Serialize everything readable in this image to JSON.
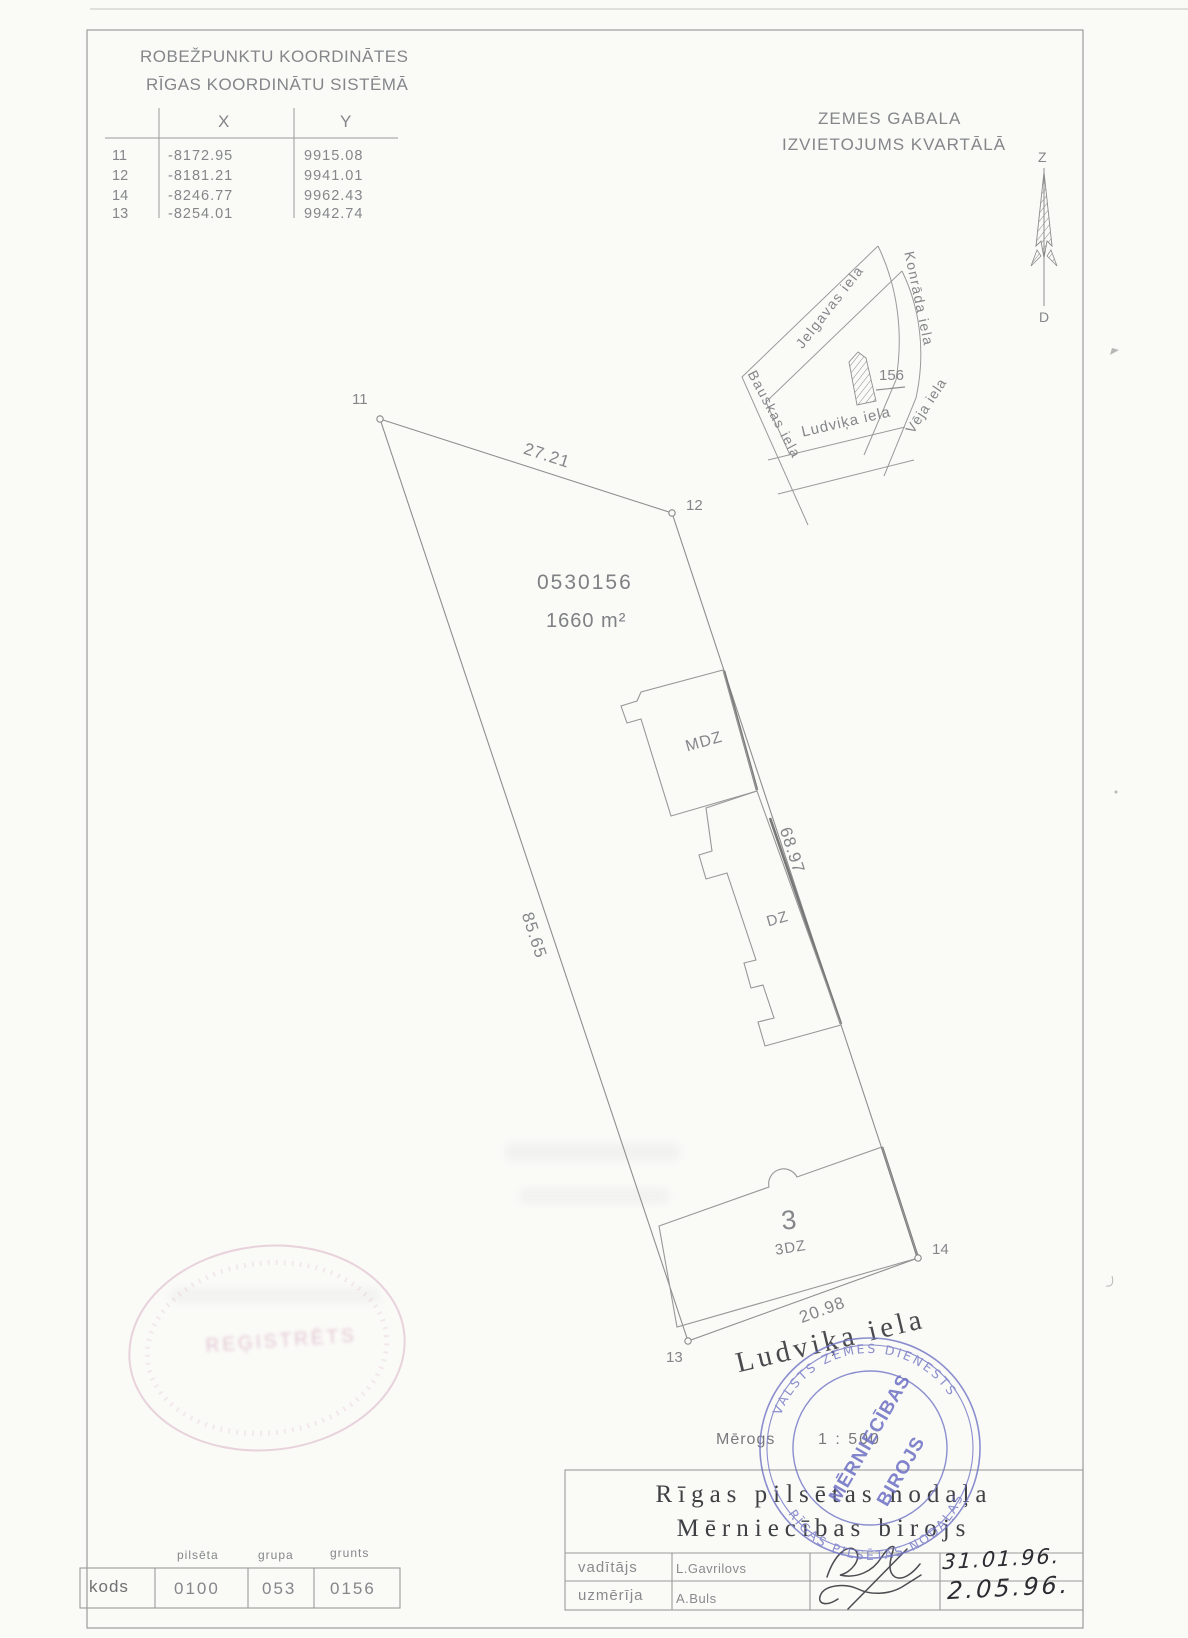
{
  "coordinate_table": {
    "title_line1": "ROBEŽPUNKTU KOORDINĀTES",
    "title_line2": "RĪGAS KOORDINĀTU SISTĒMĀ",
    "col_x": "X",
    "col_y": "Y",
    "rows": [
      {
        "point": "11",
        "x": "-8172.95",
        "y": "9915.08"
      },
      {
        "point": "12",
        "x": "-8181.21",
        "y": "9941.01"
      },
      {
        "point": "14",
        "x": "-8246.77",
        "y": "9962.43"
      },
      {
        "point": "13",
        "x": "-8254.01",
        "y": "9942.74"
      }
    ]
  },
  "location_map": {
    "title_line1": "ZEMES GABALA",
    "title_line2": "IZVIETOJUMS KVARTĀLĀ",
    "north_label": "Z",
    "south_label": "D",
    "streets": {
      "jelgavas": "Jelgavas iela",
      "konrada": "Konrāda iela",
      "bauskas": "Bauskas iela",
      "ludvika": "Ludviķa iela",
      "veja": "Vēja iela"
    },
    "parcel_label": "156"
  },
  "plan": {
    "parcel_number": "0530156",
    "area_label": "1660 m²",
    "point_labels": {
      "p11": "11",
      "p12": "12",
      "p13": "13",
      "p14": "14"
    },
    "dimensions": {
      "north": "27.21",
      "east": "68.97",
      "west": "85.65",
      "south": "20.98"
    },
    "building_labels": {
      "mdz": "MDZ",
      "dz": "DZ",
      "b3": "3",
      "b3dz": "3DZ"
    },
    "street_label": "Ludviķa iela",
    "scale_label": "Mērogs",
    "scale_value": "1 : 500"
  },
  "title_block": {
    "org_line1": "Rīgas pilsētas nodaļa",
    "org_line2": "Mērniecības birojs",
    "rows": [
      {
        "role": "vadītājs",
        "name": "L.Gavrilovs",
        "date": "31.01.96."
      },
      {
        "role": "uzmērīja",
        "name": "A.Buls",
        "date": "2.05.96."
      }
    ]
  },
  "code_table": {
    "label": "kods",
    "headers": [
      "pilsēta",
      "grupa",
      "grunts"
    ],
    "values": [
      "0100",
      "053",
      "0156"
    ]
  },
  "stamps": {
    "blue": {
      "ring_top": "VALSTS ZEMES DIENESTS",
      "ring_bottom": "RĪGAS PILSĒTAS NODAĻAS",
      "center_line1": "MĒRNIECĪBAS",
      "center_line2": "BIROJS",
      "color": "#6c70c3"
    },
    "pink": {
      "center_text": "REĢISTRĒTS",
      "color": "#c684a8"
    }
  }
}
